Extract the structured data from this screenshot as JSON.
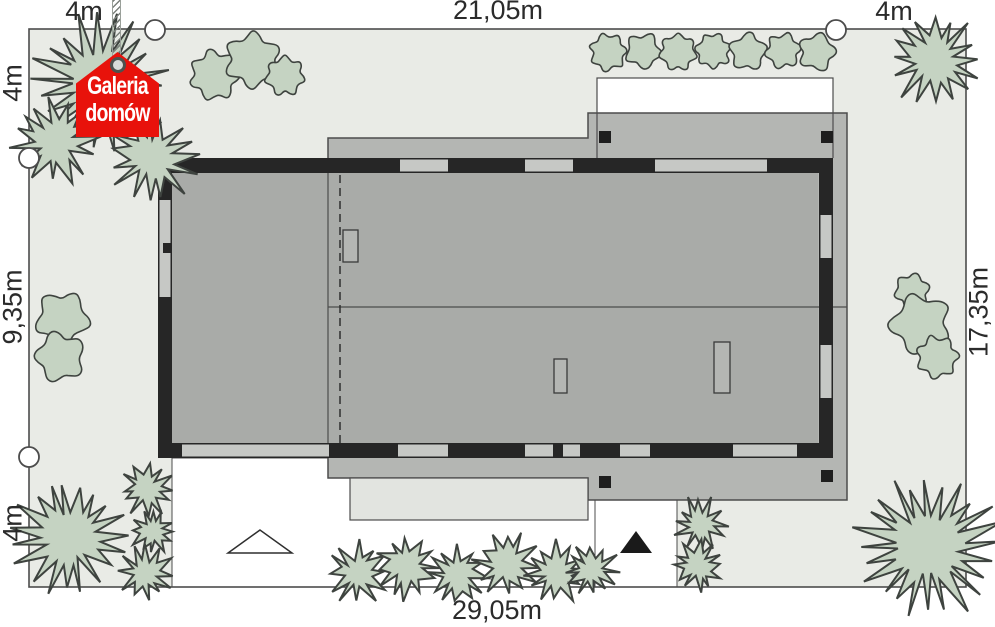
{
  "title": "house site plan",
  "dims": {
    "top_left": "4m",
    "top_center": "21,05m",
    "top_right": "4m",
    "left_top": "4m",
    "left_middle": "9,35m",
    "left_bottom": "4m",
    "right_side": "17,35m",
    "bottom": "29,05m"
  },
  "logo": {
    "line1": "Galeria",
    "line2": "domów"
  },
  "markers": {
    "boundary_marker": "circle",
    "garage_entrance_marker": "triangle-outline",
    "main_entrance_marker": "triangle-filled"
  },
  "colors": {
    "plot": "#e9ebe6",
    "border": "#4c4c4c",
    "tree_fill": "#c5d3c2",
    "tree_stroke": "#3e433f",
    "roof": "#b4b6b3",
    "interior": "#a9aba8",
    "wall": "#262626",
    "window": "#c6c8c5",
    "terrace": "#e2e4e0",
    "white": "#ffffff",
    "label": "#2b2b2b",
    "logo_red": "#e8120b"
  },
  "trees": [
    {
      "t": "s",
      "x": 100,
      "y": 85,
      "r": 68
    },
    {
      "t": "s",
      "x": 56,
      "y": 140,
      "r": 44
    },
    {
      "t": "s",
      "x": 152,
      "y": 158,
      "r": 45
    },
    {
      "t": "s",
      "x": 935,
      "y": 60,
      "r": 47
    },
    {
      "t": "s",
      "x": 70,
      "y": 537,
      "r": 57
    },
    {
      "t": "s",
      "x": 147,
      "y": 489,
      "r": 27
    },
    {
      "t": "s",
      "x": 153,
      "y": 531,
      "r": 24
    },
    {
      "t": "s",
      "x": 146,
      "y": 573,
      "r": 28
    },
    {
      "t": "s",
      "x": 357,
      "y": 573,
      "r": 31
    },
    {
      "t": "s",
      "x": 407,
      "y": 566,
      "r": 33
    },
    {
      "t": "s",
      "x": 457,
      "y": 575,
      "r": 31
    },
    {
      "t": "s",
      "x": 507,
      "y": 564,
      "r": 33
    },
    {
      "t": "s",
      "x": 556,
      "y": 573,
      "r": 31
    },
    {
      "t": "s",
      "x": 592,
      "y": 570,
      "r": 27
    },
    {
      "t": "s",
      "x": 700,
      "y": 524,
      "r": 27
    },
    {
      "t": "s",
      "x": 698,
      "y": 566,
      "r": 26
    },
    {
      "t": "s",
      "x": 928,
      "y": 546,
      "r": 71
    },
    {
      "t": "c",
      "x": 214,
      "y": 75,
      "r": 28
    },
    {
      "t": "c",
      "x": 253,
      "y": 60,
      "r": 31
    },
    {
      "t": "c",
      "x": 285,
      "y": 76,
      "r": 22
    },
    {
      "t": "c",
      "x": 62,
      "y": 318,
      "r": 30
    },
    {
      "t": "c",
      "x": 60,
      "y": 357,
      "r": 28
    },
    {
      "t": "c",
      "x": 912,
      "y": 291,
      "r": 20
    },
    {
      "t": "c",
      "x": 921,
      "y": 324,
      "r": 34
    },
    {
      "t": "c",
      "x": 937,
      "y": 357,
      "r": 24
    },
    {
      "t": "c",
      "x": 608,
      "y": 52,
      "r": 21
    },
    {
      "t": "c",
      "x": 643,
      "y": 51,
      "r": 20
    },
    {
      "t": "c",
      "x": 678,
      "y": 52,
      "r": 21
    },
    {
      "t": "c",
      "x": 713,
      "y": 51,
      "r": 20
    },
    {
      "t": "c",
      "x": 748,
      "y": 52,
      "r": 21
    },
    {
      "t": "c",
      "x": 783,
      "y": 51,
      "r": 20
    },
    {
      "t": "c",
      "x": 817,
      "y": 52,
      "r": 21
    }
  ]
}
